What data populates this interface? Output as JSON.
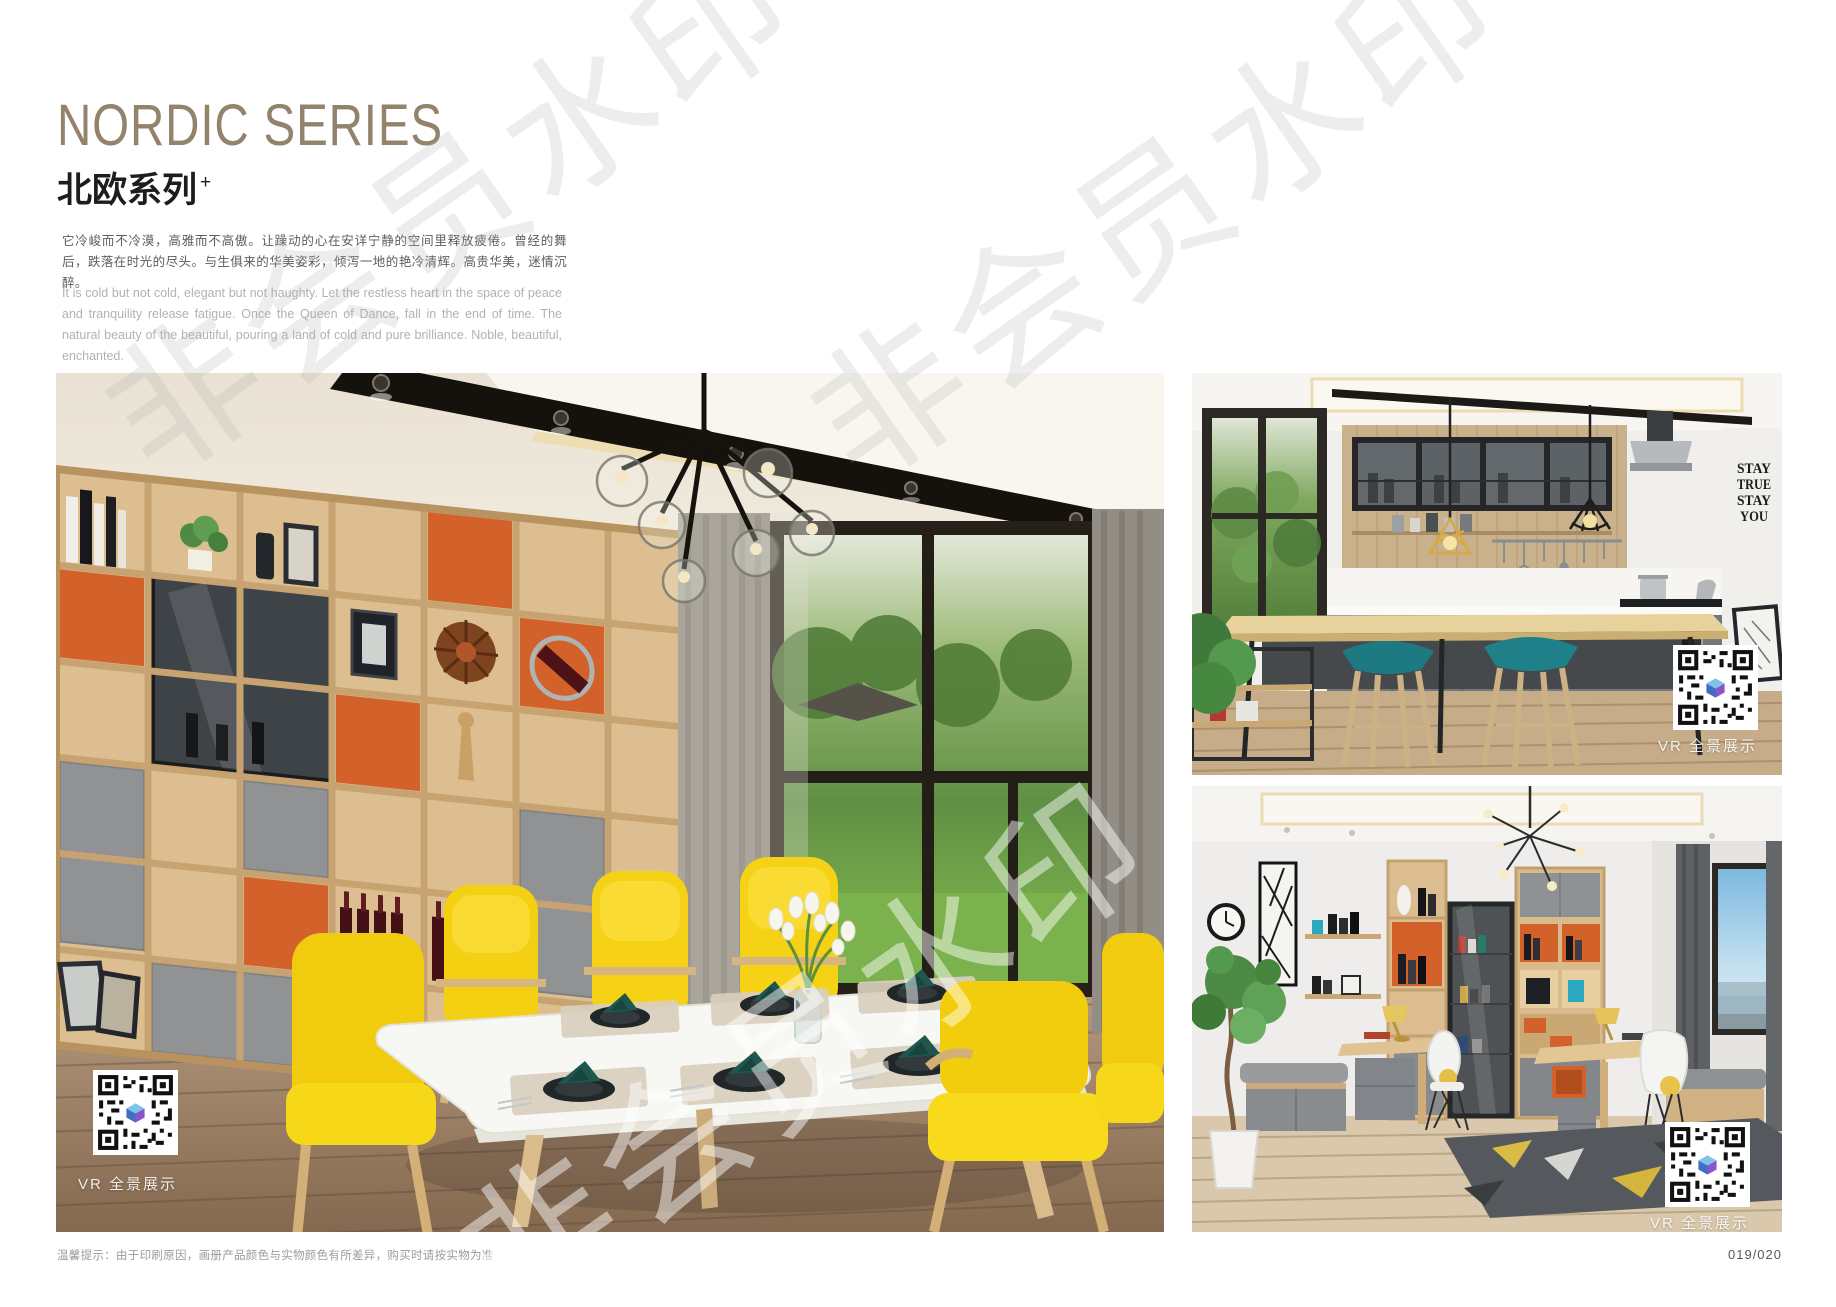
{
  "page": {
    "title_en": "NORDIC SERIES",
    "title_zh": "北欧系列",
    "title_sup": "+",
    "desc_zh": "它冷峻而不冷漠，高雅而不高傲。让躁动的心在安详宁静的空间里释放疲倦。曾经的舞后，跌落在时光的尽头。与生俱来的华美姿彩，倾泻一地的艳冷清辉。高贵华美，迷情沉醉。",
    "desc_en": "It is cold but not cold, elegant but not haughty. Let the restless heart in the space of peace and tranquility release fatigue. Once the Queen of Dance, fall in the end of time. The natural beauty of the beautiful, pouring a land of cold and pure brilliance. Noble, beautiful, enchanted.",
    "footer_note": "温馨提示：由于印刷原因，画册产品颜色与实物颜色有所差异，购买时请按实物为准",
    "page_number": "019/020",
    "watermark": "非会员水印"
  },
  "photos": {
    "dining": {
      "vr_label": "VR 全景展示"
    },
    "kitchen": {
      "vr_label": "VR 全景展示",
      "wall_text": [
        "STAY",
        "TRUE",
        "STAY",
        "YOU"
      ]
    },
    "study": {
      "vr_label": "VR 全景展示"
    }
  },
  "colors": {
    "title": "#93826c",
    "accent_orange": "#d2622a",
    "chair_yellow": "#f6d414",
    "stool_teal": "#1d7a82",
    "wood": "#d9ba8c",
    "napkin_teal": "#1f574f"
  }
}
